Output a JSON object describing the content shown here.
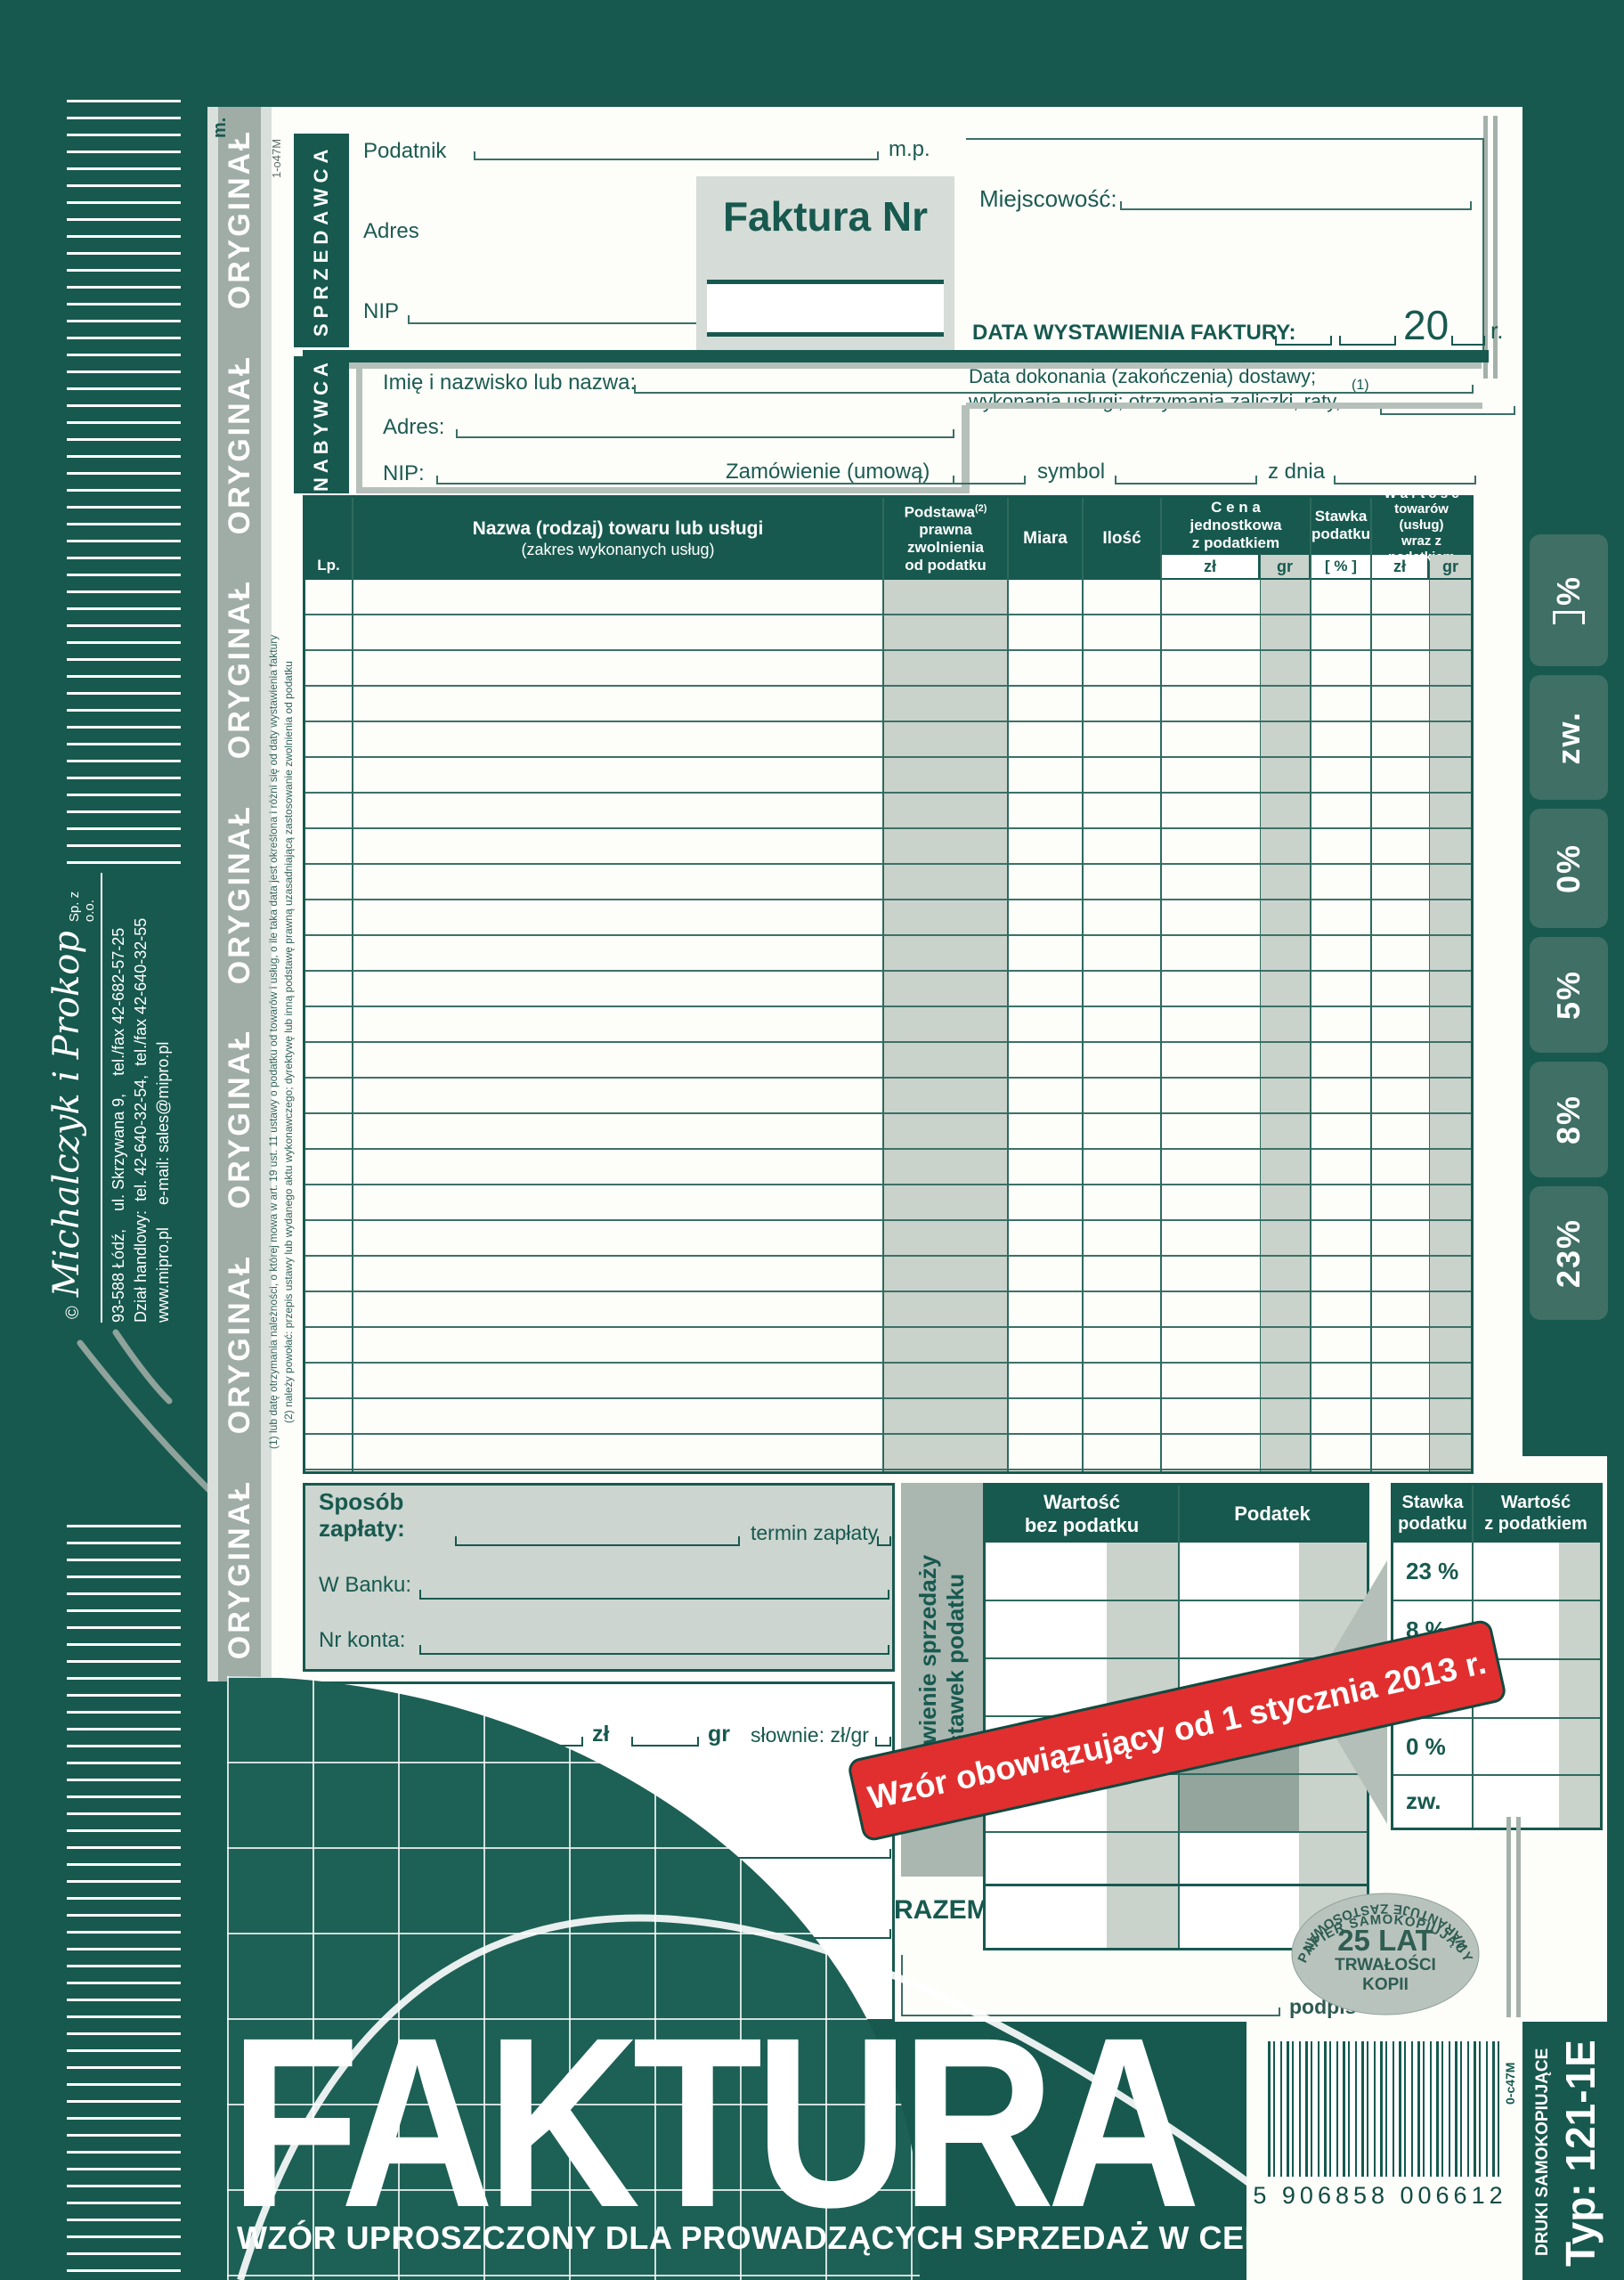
{
  "colors": {
    "brand_green": "#17594f",
    "tab_green": "#3f6f65",
    "panel_gray": "#ccd5cf",
    "shade_gray": "#c9d2cb",
    "band_gray": "#9fada6",
    "stamp_red": "#e12f2f"
  },
  "left_band": {
    "copy_label": "ORYGINAŁ",
    "top_code": "m.",
    "print_code": "1-o47M"
  },
  "company": {
    "copyright": "©",
    "name": "Michalczyk i Prokop",
    "suffix": "Sp. z o.o.",
    "address_line": "93-588 Łódź,    ul. Skrzywana 9,    tel./fax 42-682-57-25",
    "sales_line": "Dział handlowy:  tel. 42-640-32-54,  tel./fax 42-640-32-55",
    "web_line": "www.mipro.pl     e-mail: sales@mipro.pl"
  },
  "seller": {
    "label": "SPRZEDAWCA",
    "taxpayer_label": "Podatnik",
    "stamp_label": "m.p.",
    "address_label": "Adres",
    "nip_label": "NIP"
  },
  "invoice_box": {
    "title": "Faktura Nr"
  },
  "header_right": {
    "city_label": "Miejscowość:",
    "issue_date_label": "DATA WYSTAWIENIA FAKTURY:",
    "century": "20",
    "year_suffix": "r.",
    "delivery_line1": "Data dokonania (zakończenia) dostawy;",
    "delivery_line2": "wykonania usługi; otrzymania zaliczki, raty, ...",
    "footnote_ref": "(1)"
  },
  "buyer": {
    "label": "NABYWCA",
    "name_label": "Imię i nazwisko lub nazwa:",
    "address_label": "Adres:",
    "nip_label": "NIP:"
  },
  "order": {
    "order_label": "Zamówienie (umowa)",
    "symbol_label": "symbol",
    "date_label": "z dnia"
  },
  "items_table": {
    "lp": "Lp.",
    "name_l1": "Nazwa (rodzaj) towaru lub usługi",
    "name_l2": "(zakres wykonanych usług)",
    "basis_l1": "Podstawa",
    "basis_sup": "(2)",
    "basis_l2": "prawna",
    "basis_l3": "zwolnienia",
    "basis_l4": "od podatku",
    "unit": "Miara",
    "qty": "Ilość",
    "price_l1": "C e n a",
    "price_l2": "jednostkowa",
    "price_l3": "z podatkiem",
    "rate_l1": "Stawka",
    "rate_l2": "podatku",
    "value_l1": "W a r t o ś ć",
    "value_l2": "towarów (usług)",
    "value_l3": "wraz z podatkiem",
    "sub_zl": "zł",
    "sub_gr": "gr",
    "sub_pct": "[ % ]"
  },
  "rate_tabs": [
    {
      "label": "%"
    },
    {
      "label": "zw."
    },
    {
      "label": "0%"
    },
    {
      "label": "5%"
    },
    {
      "label": "8%"
    },
    {
      "label": "23%"
    }
  ],
  "payment": {
    "method_l1": "Sposób",
    "method_l2": "zapłaty:",
    "term_label": "termin zapłaty",
    "bank_label": "W Banku:",
    "account_label": "Nr konta:"
  },
  "due": {
    "l1": "Do",
    "l2": "zapłaty:",
    "zl": "zł",
    "gr": "gr",
    "words_label": "słownie: zł/gr"
  },
  "summary": {
    "side_l1": "Zestawienie sprzedaży",
    "side_l2": "wg stawek podatku",
    "col_net_l1": "Wartość",
    "col_net_l2": "bez podatku",
    "col_tax": "Podatek",
    "col_rate_l1": "Stawka",
    "col_rate_l2": "podatku",
    "col_gross_l1": "Wartość",
    "col_gross_l2": "z podatkiem",
    "rates": [
      "23 %",
      "8 %",
      "5 %",
      "0 %",
      "zw."
    ],
    "total_label": "RAZEM"
  },
  "stamp": {
    "text": "Wzór obowiązujący od 1 stycznia 2013 r."
  },
  "signature": {
    "label": "podpis"
  },
  "badge": {
    "arc_top": "PAPIER SAMOKOPIUJĄCY",
    "big": "25 LAT",
    "mid": "TRWAŁOŚCI",
    "bottom": "KOPII",
    "arc_bottom": "GWARANTUJE ZASTOSOWANY"
  },
  "footnotes": {
    "f1": "(1) lub datę otrzymania należności, o której mowa w art. 19 ust. 11 ustawy o podatku od towarów i usług, o ile taka data jest określona i różni się od daty wystawienia faktury",
    "f2": "(2) należy powołać: przepis ustawy lub wydanego aktu wykonawczego; dyrektywę lub inną podstawę prawną uzasadniającą zastosowanie zwolnienia od podatku"
  },
  "footer": {
    "title": "FAKTURA",
    "subtitle": "WZÓR UPROSZCZONY DLA PROWADZĄCYCH SPRZEDAŻ W CENACH BRUTTO"
  },
  "barcode": {
    "digits": "5 906858 006612",
    "print_code": "0-c47M",
    "product": "DRUKI SAMOKOPIUJĄCE",
    "type": "Typ: 121-1E"
  }
}
